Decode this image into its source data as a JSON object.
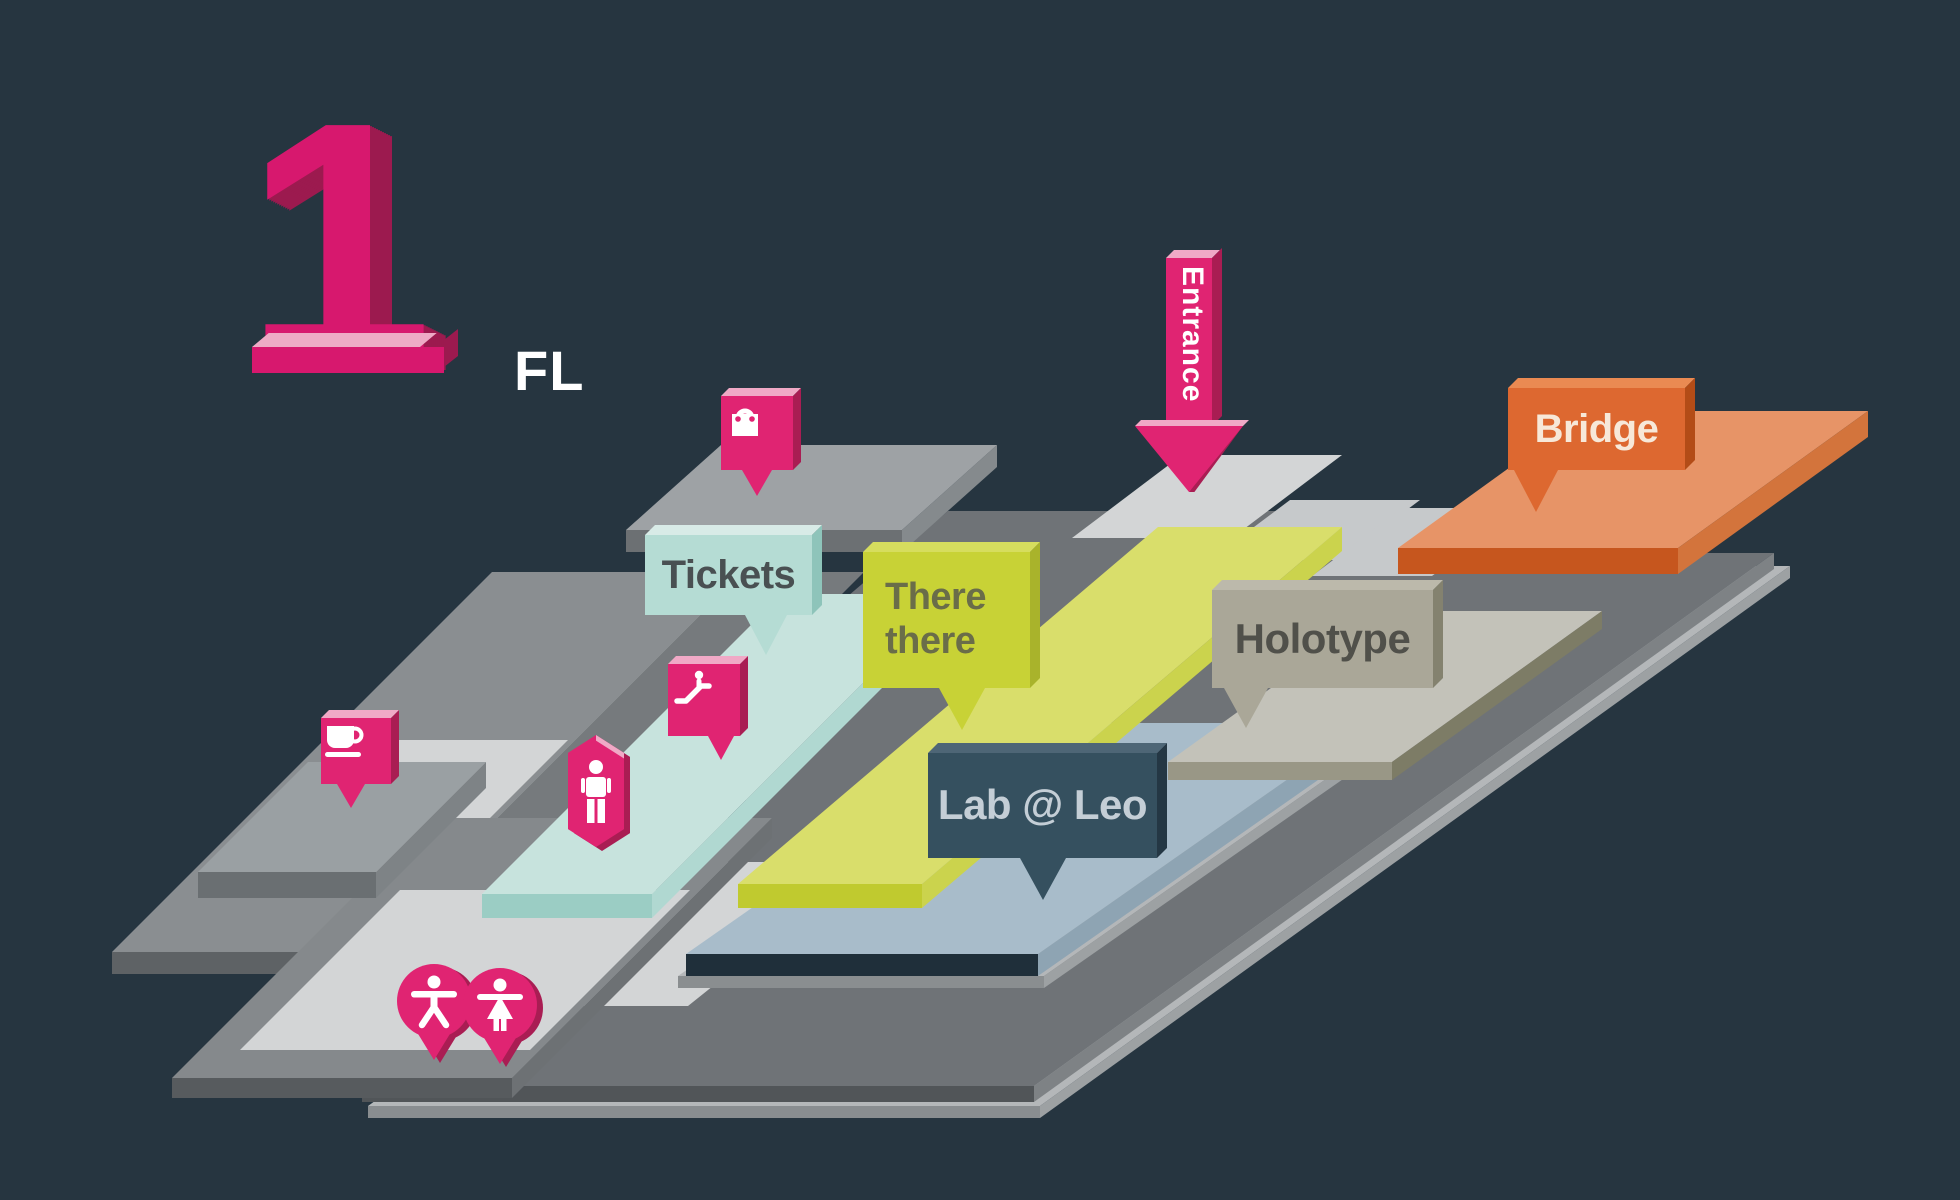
{
  "floor_indicator": {
    "number": "1",
    "suffix": "FL"
  },
  "entrance": {
    "label": "Entrance"
  },
  "areas": [
    {
      "id": "tickets",
      "label": "Tickets",
      "color": "#b5dcd4"
    },
    {
      "id": "there_there",
      "label": "There there",
      "line1": "There",
      "line2": "there",
      "color": "#c8d236"
    },
    {
      "id": "holotype",
      "label": "Holotype",
      "color": "#aaa798"
    },
    {
      "id": "lab_leo",
      "label": "Lab @ Leo",
      "color": "#35505f"
    },
    {
      "id": "bridge",
      "label": "Bridge",
      "color": "#dd6830"
    }
  ],
  "markers": [
    {
      "id": "shop",
      "icon": "shopping-bag-icon"
    },
    {
      "id": "escalator",
      "icon": "escalator-icon"
    },
    {
      "id": "information",
      "icon": "person-icon"
    },
    {
      "id": "cafe",
      "icon": "coffee-cup-icon"
    },
    {
      "id": "restroom_men",
      "icon": "male-figure-icon"
    },
    {
      "id": "restroom_women",
      "icon": "female-figure-icon"
    }
  ],
  "colors": {
    "background": "#263540",
    "accent_pink": "#e02472",
    "floor_gray": "#6f7377",
    "light_path": "#d3d5d6"
  }
}
